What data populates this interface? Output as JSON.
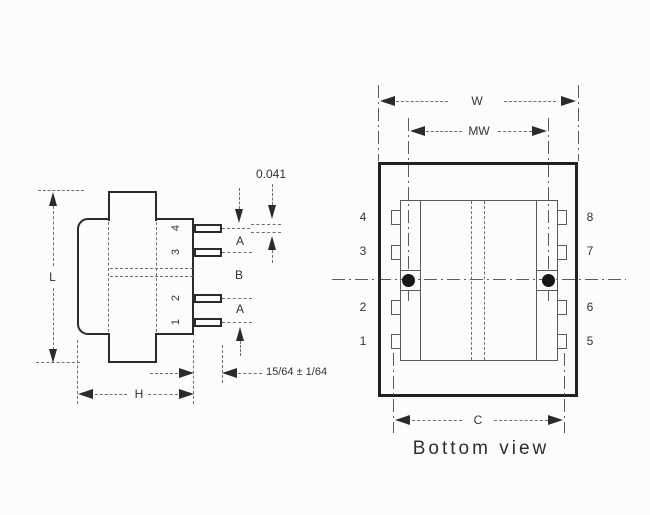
{
  "side_view": {
    "pin_labels": [
      "4",
      "3",
      "2",
      "1"
    ],
    "dims": {
      "l": "L",
      "h": "H",
      "a_top": "A",
      "b": "B",
      "a_bottom": "A",
      "pin_thickness": "0.041",
      "pin_length": "15/64 ± 1/64"
    }
  },
  "bottom_view": {
    "caption": "Bottom view",
    "dims": {
      "w": "W",
      "mw": "MW",
      "c": "C"
    },
    "left_pin_labels": [
      "4",
      "3",
      "2",
      "1"
    ],
    "right_pin_labels": [
      "8",
      "7",
      "6",
      "5"
    ]
  },
  "colors": {
    "ink": "#2b2b2b",
    "thin_line": "#595959",
    "dim_line": "#6f6f6f",
    "paper": "#fcfcfb",
    "hole": "#171717"
  }
}
